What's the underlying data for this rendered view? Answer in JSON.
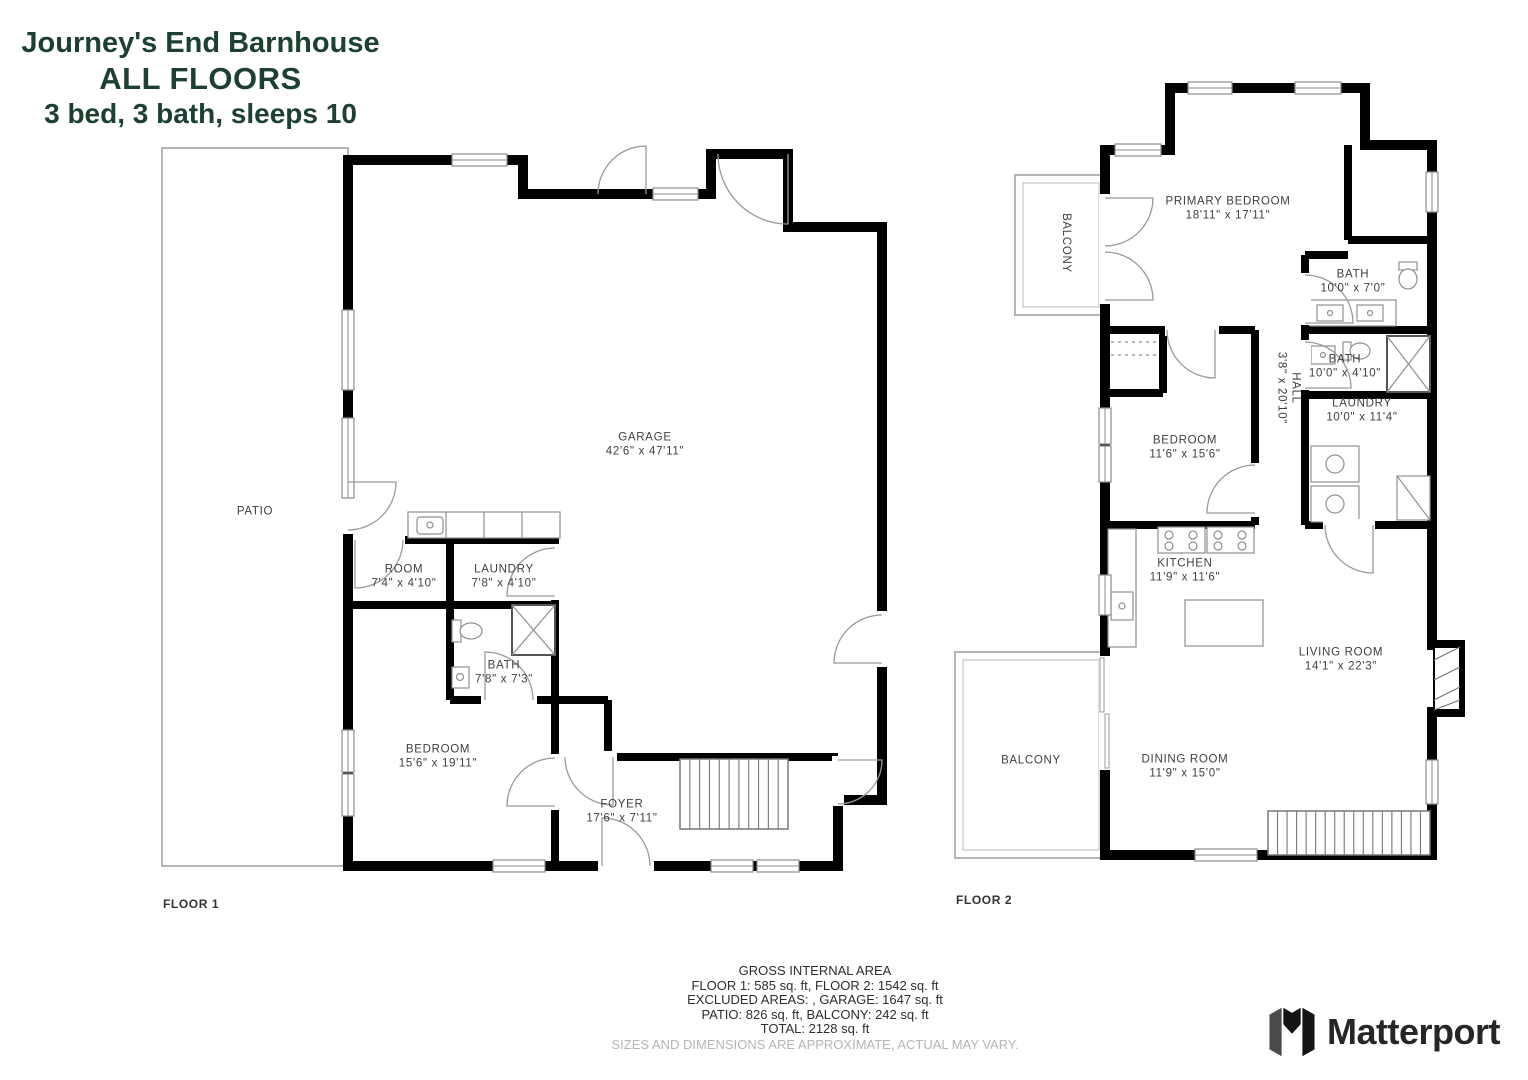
{
  "title": {
    "line1": "Journey's End Barnhouse",
    "line2": "ALL FLOORS",
    "line3": "3 bed, 3 bath, sleeps 10"
  },
  "floor1": {
    "label": "FLOOR 1",
    "patio": {
      "name": "PATIO"
    },
    "rooms": [
      {
        "name": "GARAGE",
        "dims": "42'6\" x 47'11\""
      },
      {
        "name": "ROOM",
        "dims": "7'4\" x 4'10\""
      },
      {
        "name": "LAUNDRY",
        "dims": "7'8\" x 4'10\""
      },
      {
        "name": "BATH",
        "dims": "7'8\" x 7'3\""
      },
      {
        "name": "BEDROOM",
        "dims": "15'6\" x 19'11\""
      },
      {
        "name": "FOYER",
        "dims": "17'6\" x 7'11\""
      }
    ]
  },
  "floor2": {
    "label": "FLOOR 2",
    "balcony_top": "BALCONY",
    "balcony_bottom": "BALCONY",
    "rooms": [
      {
        "name": "PRIMARY BEDROOM",
        "dims": "18'11\" x 17'11\""
      },
      {
        "name": "BATH",
        "dims": "10'0\" x 7'0\""
      },
      {
        "name": "BATH",
        "dims": "10'0\" x 4'10\""
      },
      {
        "name": "HALL",
        "dims": "3'8\" x 20'10\""
      },
      {
        "name": "LAUNDRY",
        "dims": "10'0\" x 11'4\""
      },
      {
        "name": "BEDROOM",
        "dims": "11'6\" x 15'6\""
      },
      {
        "name": "KITCHEN",
        "dims": "11'9\" x 11'6\""
      },
      {
        "name": "LIVING ROOM",
        "dims": "14'1\" x 22'3\""
      },
      {
        "name": "DINING ROOM",
        "dims": "11'9\" x 15'0\""
      }
    ]
  },
  "footer": {
    "title": "GROSS INTERNAL AREA",
    "lines": [
      "FLOOR 1: 585 sq. ft, FLOOR 2: 1542 sq. ft",
      "EXCLUDED AREAS: , GARAGE: 1647 sq. ft",
      "PATIO: 826 sq. ft, BALCONY: 242 sq. ft",
      "TOTAL: 2128 sq. ft"
    ],
    "disclaimer": "SIZES AND DIMENSIONS ARE APPROXIMATE, ACTUAL MAY VARY."
  },
  "brand": {
    "name": "Matterport"
  },
  "colors": {
    "title_green": "#1d4030",
    "wall": "#000000",
    "disclaimer_gray": "#b5b5b5"
  }
}
